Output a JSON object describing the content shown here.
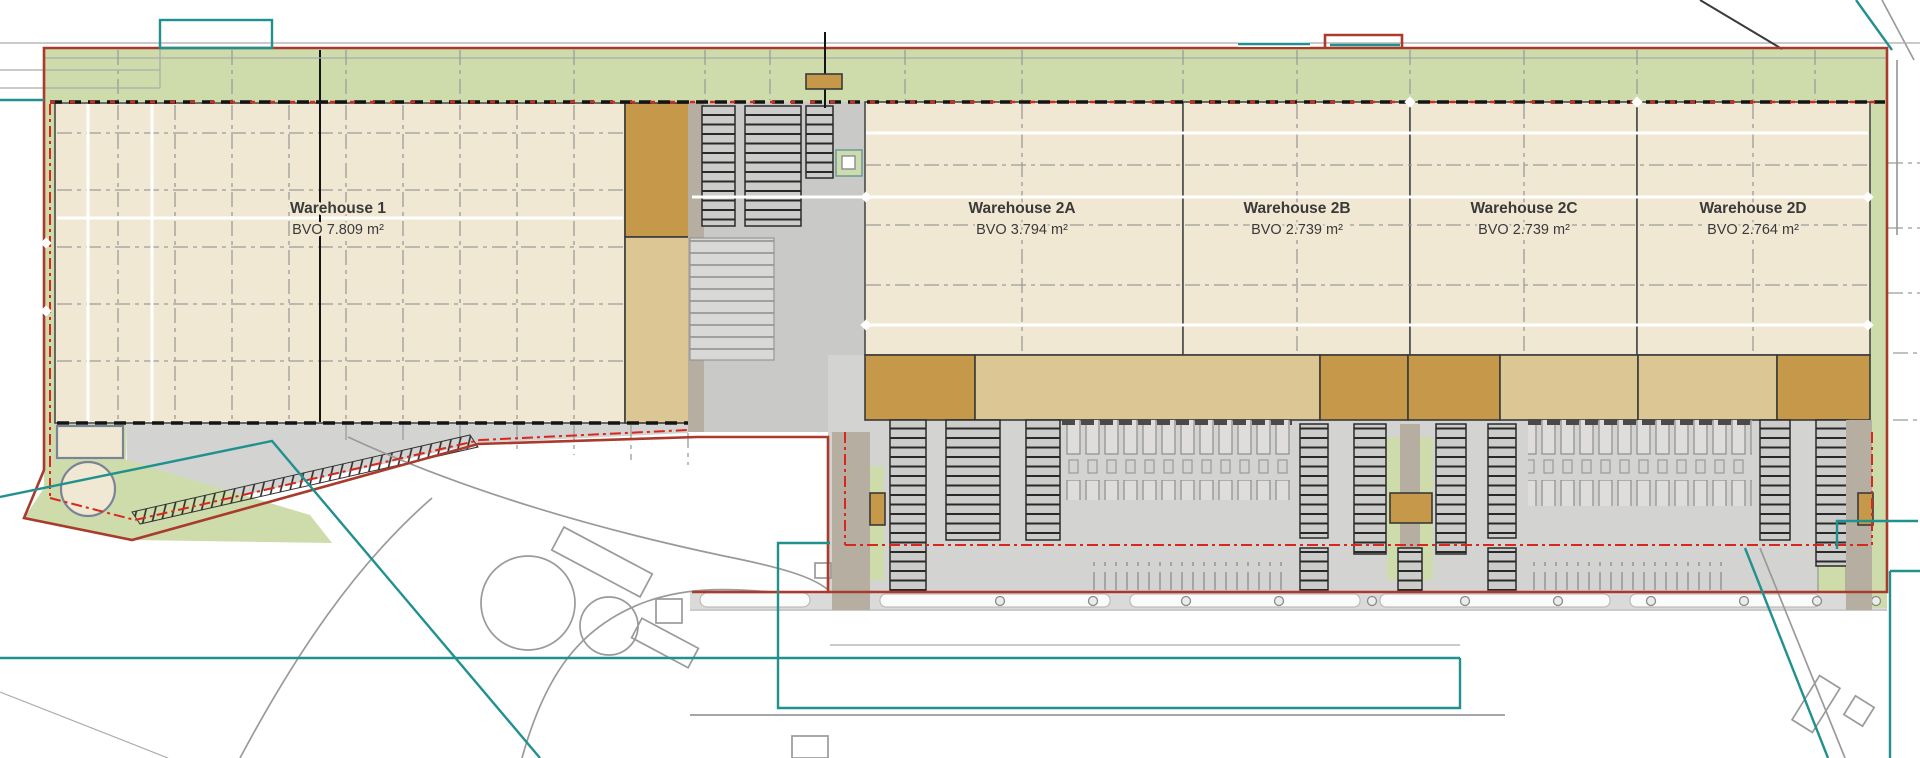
{
  "plan": {
    "warehouses": [
      {
        "name": "Warehouse 1",
        "area": "BVO 7.809 m²"
      },
      {
        "name": "Warehouse 2A",
        "area": "BVO 3.794 m²"
      },
      {
        "name": "Warehouse 2B",
        "area": "BVO 2.739 m²"
      },
      {
        "name": "Warehouse 2C",
        "area": "BVO 2.739 m²"
      },
      {
        "name": "Warehouse 2D",
        "area": "BVO 2.764 m²"
      }
    ]
  },
  "colors": {
    "beige": "#f1e8d4",
    "green": "#cedcab",
    "tan_dark": "#c6994a",
    "tan_light": "#dcc694",
    "paving": "#d3d3d1",
    "paving_dark": "#c9c9c7",
    "taupe": "#b6aea1",
    "boundary_red": "#a93a2c",
    "dashed_red": "#d8271c",
    "teal": "#21918f",
    "line_gray": "#9a9a9a",
    "text": "#3a3a3a"
  }
}
